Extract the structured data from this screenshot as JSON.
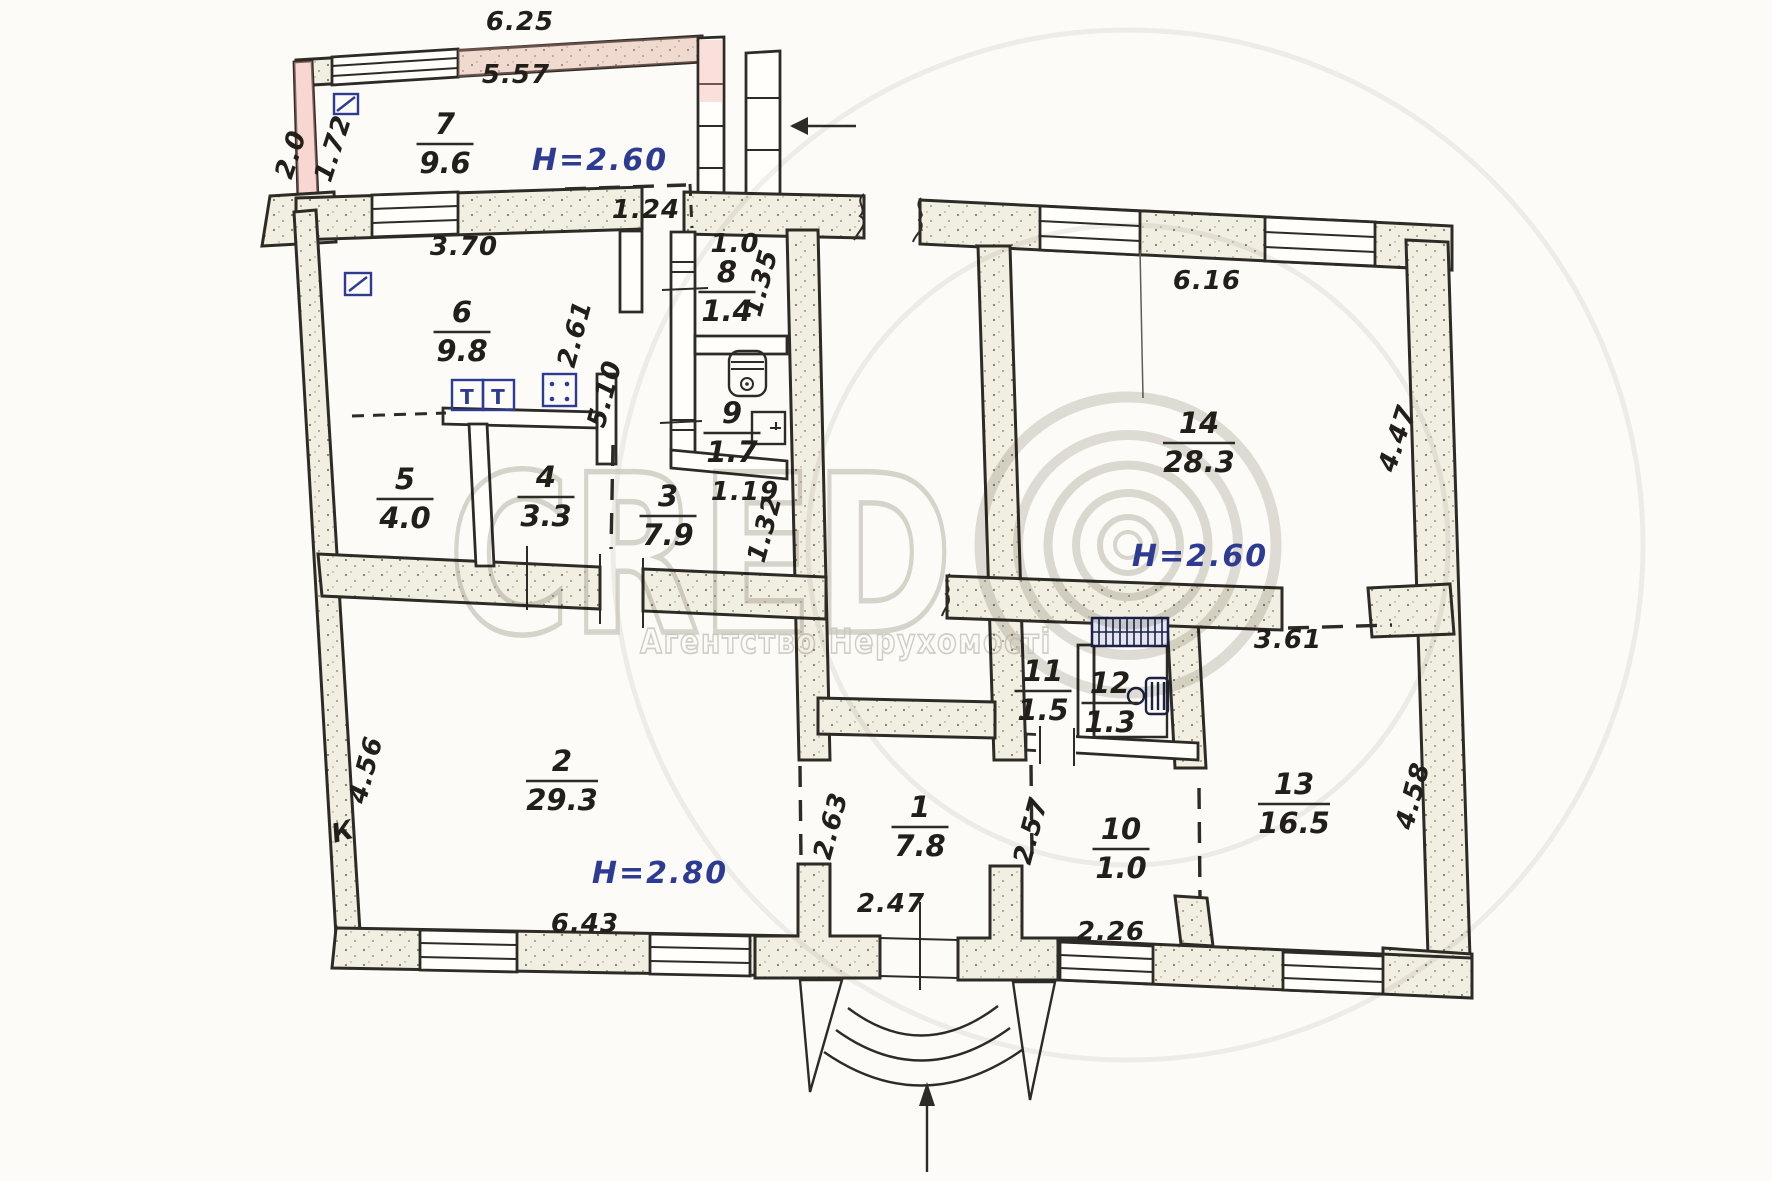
{
  "plan": {
    "paper_color": "#fcfbf7",
    "ink_color": "#2e2b26",
    "blue_ink": "#2d3b93",
    "rooms": [
      {
        "number": "7",
        "area": "9.6",
        "x": 445,
        "y": 143
      },
      {
        "number": "6",
        "area": "9.8",
        "x": 462,
        "y": 331
      },
      {
        "number": "8",
        "area": "1.4",
        "x": 727,
        "y": 291
      },
      {
        "number": "9",
        "area": "1.7",
        "x": 732,
        "y": 432
      },
      {
        "number": "5",
        "area": "4.0",
        "x": 405,
        "y": 498
      },
      {
        "number": "4",
        "area": "3.3",
        "x": 546,
        "y": 496
      },
      {
        "number": "3",
        "area": "7.9",
        "x": 668,
        "y": 515
      },
      {
        "number": "14",
        "area": "28.3",
        "x": 1199,
        "y": 442
      },
      {
        "number": "2",
        "area": "29.3",
        "x": 562,
        "y": 780
      },
      {
        "number": "1",
        "area": "7.8",
        "x": 920,
        "y": 826
      },
      {
        "number": "11",
        "area": "1.5",
        "x": 1043,
        "y": 690
      },
      {
        "number": "12",
        "area": "1.3",
        "x": 1110,
        "y": 702
      },
      {
        "number": "10",
        "area": "1.0",
        "x": 1121,
        "y": 848
      },
      {
        "number": "13",
        "area": "16.5",
        "x": 1294,
        "y": 803
      }
    ],
    "heights": [
      {
        "label": "H=2.60",
        "x": 600,
        "y": 170
      },
      {
        "label": "H=2.60",
        "x": 1200,
        "y": 566
      },
      {
        "label": "H=2.80",
        "x": 660,
        "y": 883
      }
    ],
    "dimensions": [
      {
        "value": "6.25",
        "x": 520,
        "y": 30,
        "r": 0
      },
      {
        "value": "5.57",
        "x": 516,
        "y": 83,
        "r": 0
      },
      {
        "value": "2.0",
        "x": 299,
        "y": 157,
        "r": -72
      },
      {
        "value": "1.72",
        "x": 341,
        "y": 151,
        "r": -72
      },
      {
        "value": "3.70",
        "x": 464,
        "y": 255,
        "r": 0
      },
      {
        "value": "1.24",
        "x": 646,
        "y": 218,
        "r": 0
      },
      {
        "value": "1.0",
        "x": 735,
        "y": 252,
        "r": 0
      },
      {
        "value": "1.35",
        "x": 769,
        "y": 285,
        "r": -75
      },
      {
        "value": "2.61",
        "x": 583,
        "y": 336,
        "r": -75
      },
      {
        "value": "5.10",
        "x": 613,
        "y": 396,
        "r": -75
      },
      {
        "value": "1.19",
        "x": 745,
        "y": 500,
        "r": 0
      },
      {
        "value": "1.32",
        "x": 773,
        "y": 531,
        "r": -75
      },
      {
        "value": "6.16",
        "x": 1207,
        "y": 289,
        "r": 0
      },
      {
        "value": "4.47",
        "x": 1405,
        "y": 441,
        "r": -72
      },
      {
        "value": "3.61",
        "x": 1288,
        "y": 648,
        "r": 0
      },
      {
        "value": "4.56",
        "x": 374,
        "y": 772,
        "r": -75
      },
      {
        "value": "6.43",
        "x": 585,
        "y": 932,
        "r": 0
      },
      {
        "value": "2.63",
        "x": 839,
        "y": 828,
        "r": -75
      },
      {
        "value": "2.47",
        "x": 891,
        "y": 912,
        "r": 0
      },
      {
        "value": "2.57",
        "x": 1039,
        "y": 833,
        "r": -75
      },
      {
        "value": "2.26",
        "x": 1111,
        "y": 940,
        "r": 0
      },
      {
        "value": "4.58",
        "x": 1421,
        "y": 798,
        "r": -75
      }
    ],
    "misc_labels": [
      {
        "value": "К",
        "x": 345,
        "y": 840,
        "r": -15
      }
    ],
    "fixtures": {
      "table_mark": "Т"
    },
    "entrance": {
      "direction": "up"
    },
    "watermark": {
      "brand": "CRED",
      "subtitle": "Агентство Нерухомості",
      "color": "#cdcac3"
    }
  }
}
